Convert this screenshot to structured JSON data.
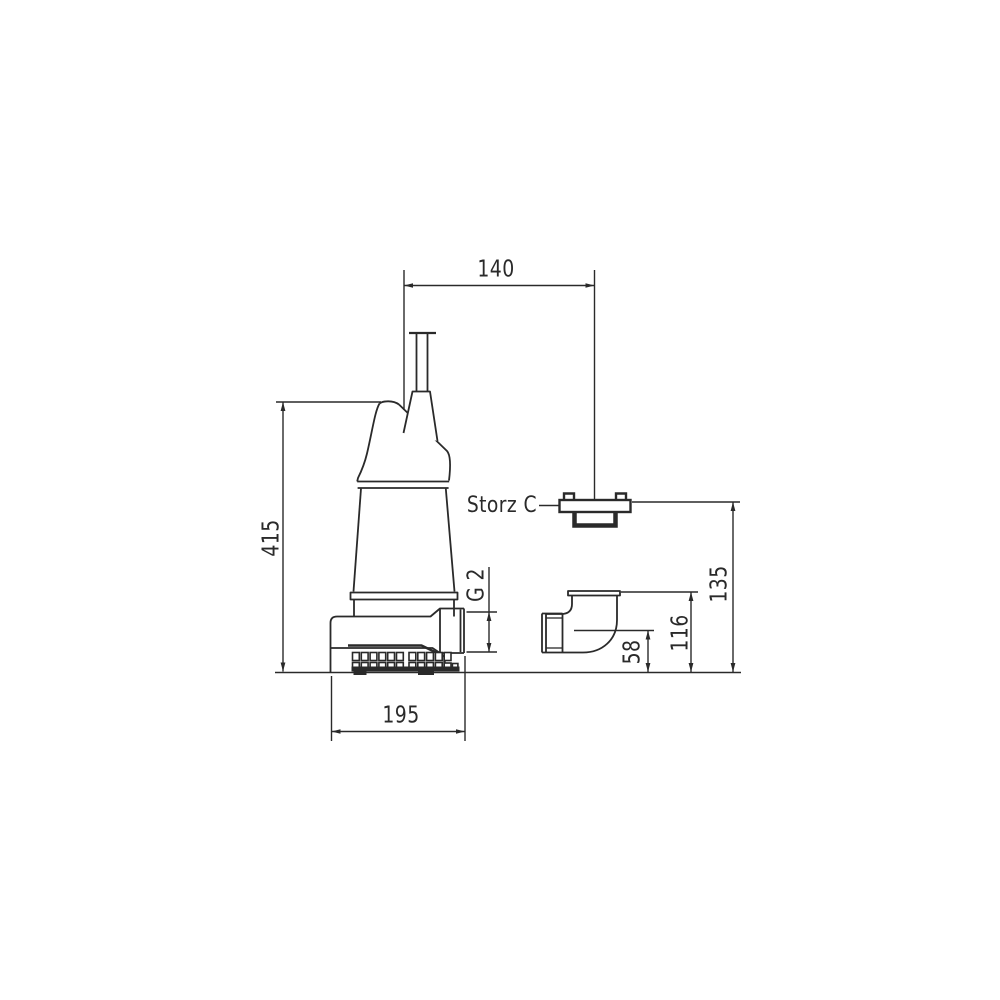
{
  "drawing": {
    "line_color": "#2a2a2a",
    "background_color": "#ffffff",
    "dimensions": {
      "top_width": "140",
      "overall_height": "415",
      "base_width": "195",
      "outlet_centerline_height": "58",
      "elbow_flange_height": "116",
      "coupling_height": "135"
    },
    "labels": {
      "coupling_type": "Storz C",
      "outlet_thread": "G 2"
    }
  }
}
